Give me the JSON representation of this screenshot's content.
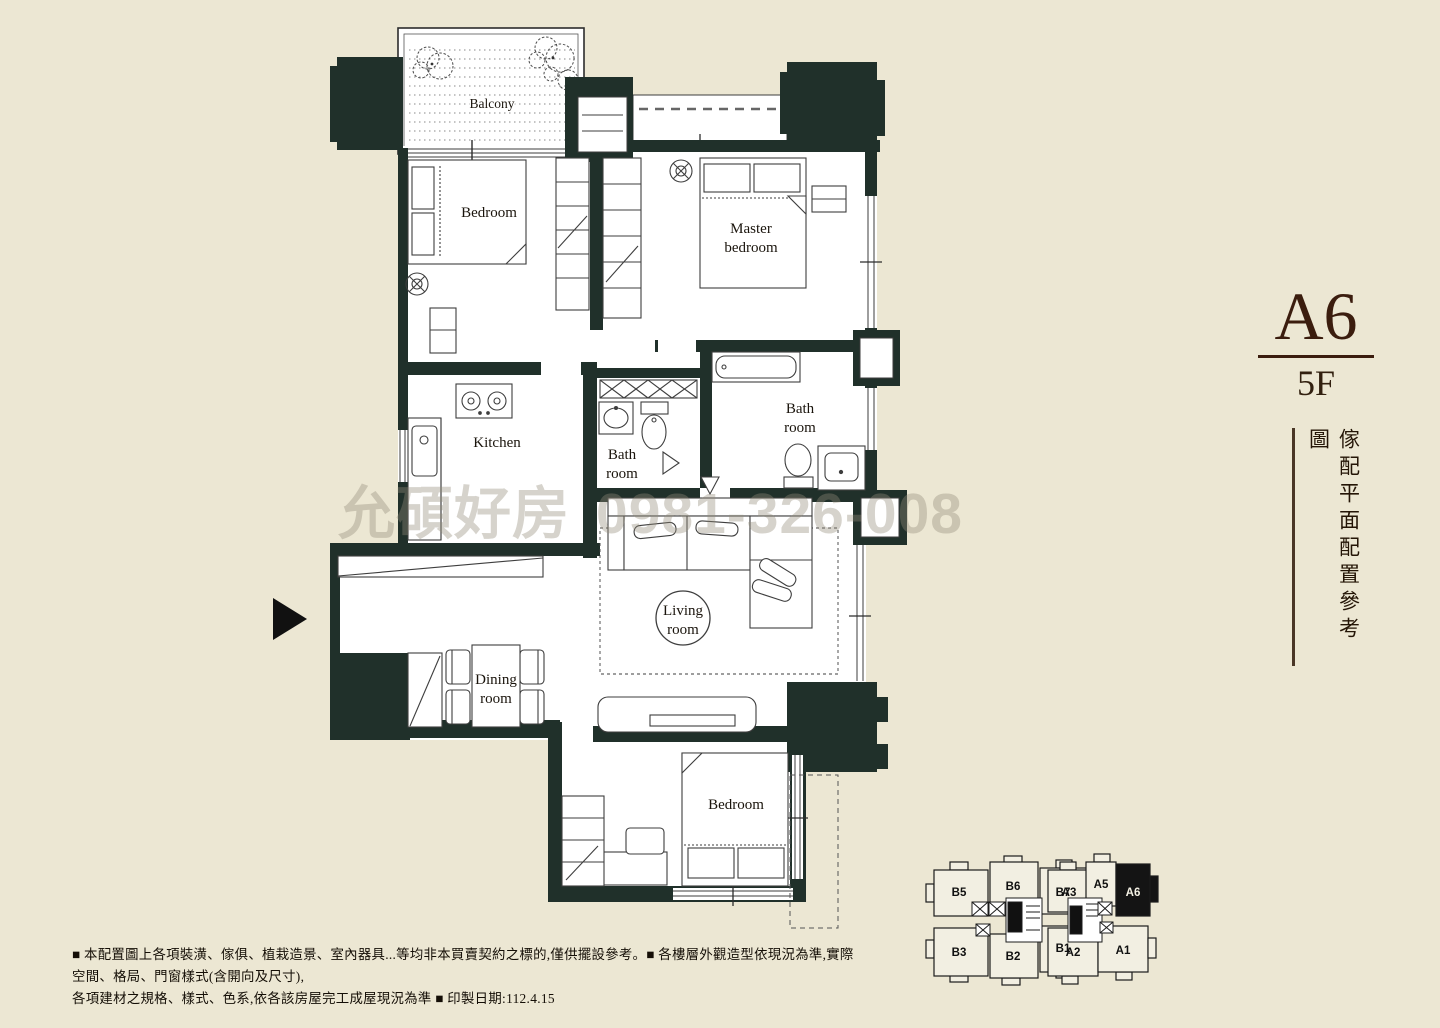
{
  "title": {
    "unit": "A6",
    "floor": "5F",
    "caption": "傢配平面配置參考圖"
  },
  "watermark": {
    "text": "允碩好房",
    "phone": "0981-326-008"
  },
  "floorplan": {
    "rooms": {
      "balcony": "Balcony",
      "bedroom_top": "Bedroom",
      "master": [
        "Master",
        "bedroom"
      ],
      "kitchen": "Kitchen",
      "bath_small": [
        "Bath",
        "room"
      ],
      "bath_main": [
        "Bath",
        "room"
      ],
      "living": [
        "Living",
        "room"
      ],
      "dining": [
        "Dining",
        "room"
      ],
      "bedroom_bottom": "Bedroom"
    }
  },
  "keyplan": {
    "units": [
      "B5",
      "B6",
      "B7",
      "B3",
      "B2",
      "B1",
      "A3",
      "A5",
      "A6",
      "A2",
      "A1"
    ],
    "highlighted": "A6"
  },
  "disclaimer": {
    "line1": "■ 本配置圖上各項裝潢、傢俱、植栽造景、室內器具...等均非本買賣契約之標的,僅供擺設參考。■ 各樓層外觀造型依現況為準,實際空間、格局、門窗樣式(含開向及尺寸),",
    "line2": "各項建材之規格、樣式、色系,依各該房屋完工成屋現況為準 ■ 印製日期:112.4.15"
  },
  "colors": {
    "background": "#ece7d3",
    "wall": "#20302a",
    "title": "#3b1d0e",
    "line": "#3c3c3c"
  }
}
